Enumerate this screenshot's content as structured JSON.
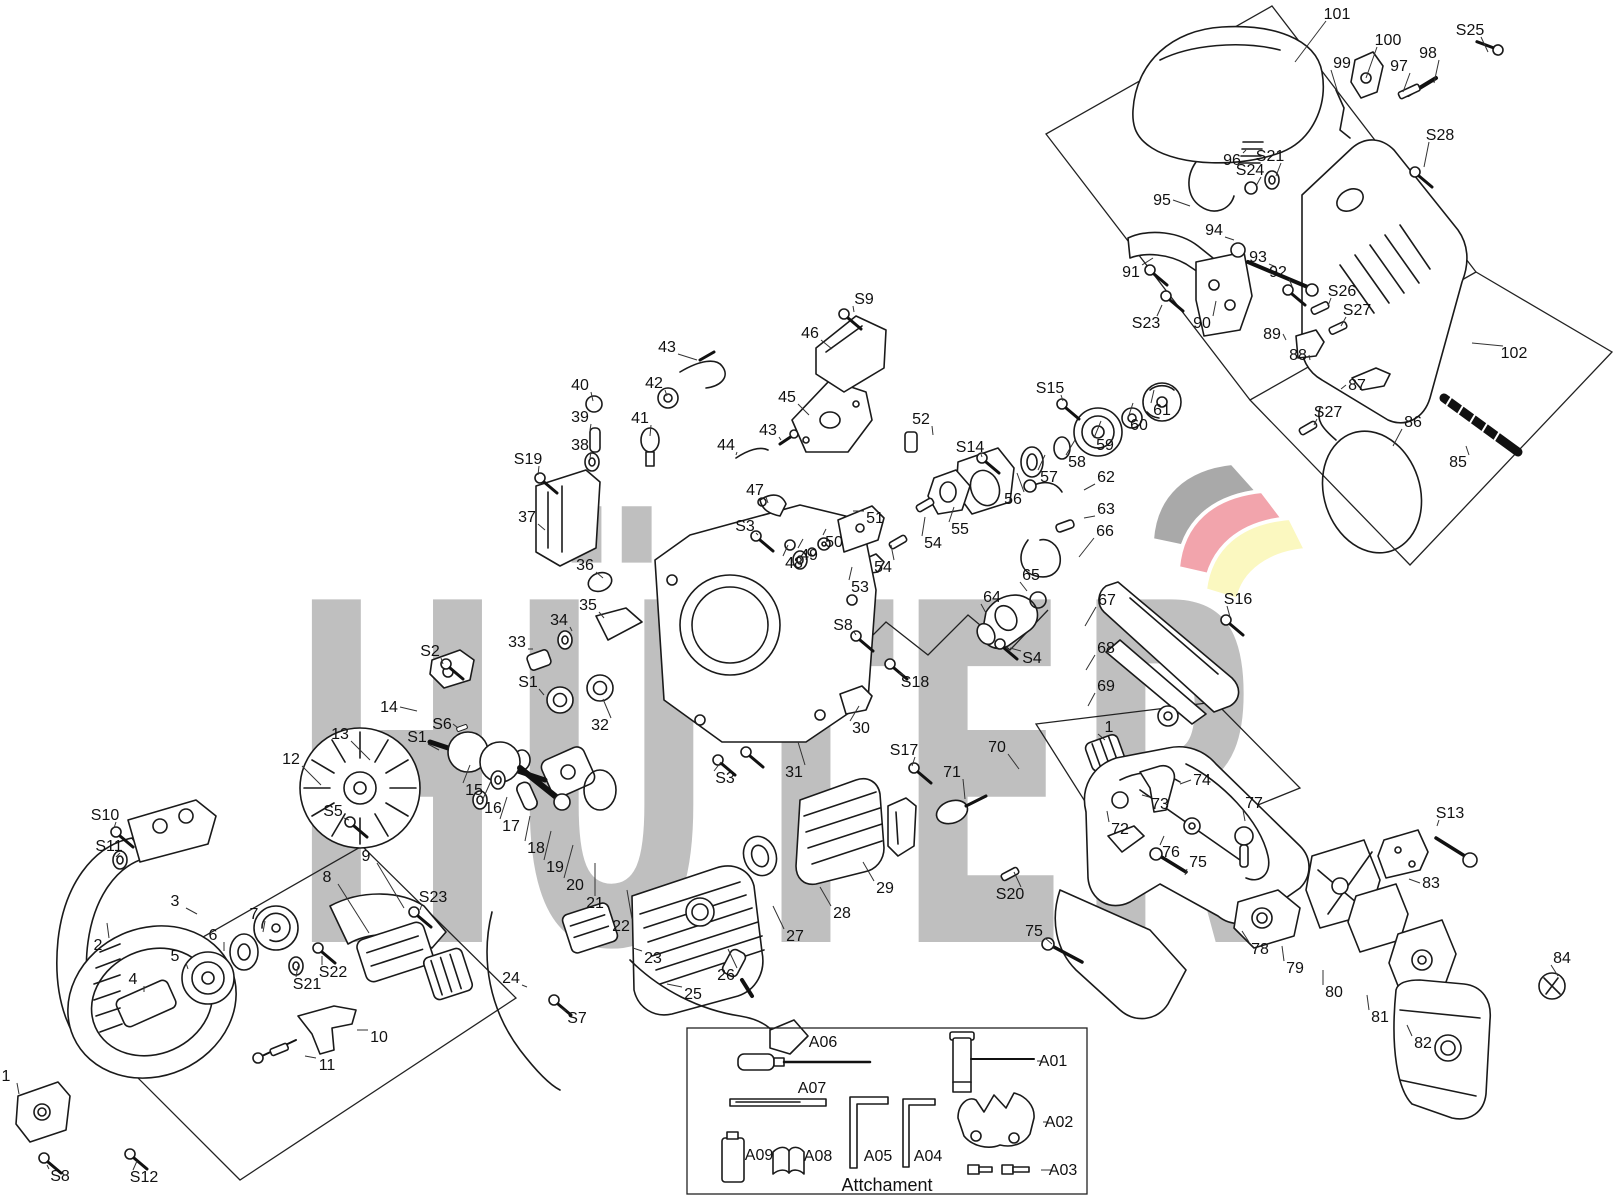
{
  "watermark": {
    "text": "HÜTER",
    "color": "#bfbfbf"
  },
  "logo": {
    "gray": "#a9a9a9",
    "red": "#f2a4ac",
    "yellow": "#fbf8c0"
  },
  "attachment_box": {
    "caption": "Attchament"
  },
  "labels": {
    "format": [
      "text",
      "x",
      "y",
      "leader_dx",
      "leader_dy"
    ],
    "items": [
      [
        "101",
        1337,
        14,
        -42,
        48
      ],
      [
        "100",
        1388,
        40,
        -22,
        38
      ],
      [
        "S25",
        1470,
        30,
        18,
        22
      ],
      [
        "99",
        1342,
        63,
        -4,
        30
      ],
      [
        "97",
        1399,
        66,
        4,
        26
      ],
      [
        "98",
        1428,
        53,
        6,
        30
      ],
      [
        "S28",
        1440,
        135,
        -16,
        32
      ],
      [
        "96",
        1232,
        160,
        14,
        -10
      ],
      [
        "S24",
        1250,
        170,
        6,
        16
      ],
      [
        "S21",
        1270,
        156,
        6,
        20
      ],
      [
        "95",
        1162,
        200,
        28,
        6
      ],
      [
        "94",
        1214,
        230,
        20,
        10
      ],
      [
        "93",
        1258,
        257,
        18,
        10
      ],
      [
        "92",
        1278,
        272,
        14,
        14
      ],
      [
        "S26",
        1342,
        291,
        -14,
        15
      ],
      [
        "S27",
        1357,
        310,
        -16,
        16
      ],
      [
        "91",
        1131,
        272,
        22,
        -14
      ],
      [
        "S23",
        1146,
        323,
        16,
        -18
      ],
      [
        "90",
        1202,
        323,
        14,
        -22
      ],
      [
        "89",
        1272,
        334,
        14,
        6
      ],
      [
        "88",
        1298,
        355,
        12,
        5
      ],
      [
        "87",
        1357,
        385,
        -16,
        4
      ],
      [
        "102",
        1514,
        353,
        -42,
        -10
      ],
      [
        "S27",
        1328,
        412,
        -14,
        13
      ],
      [
        "86",
        1413,
        422,
        -20,
        24
      ],
      [
        "85",
        1458,
        462,
        8,
        -16
      ],
      [
        "S15",
        1050,
        388,
        13,
        13
      ],
      [
        "52",
        921,
        419,
        12,
        16
      ],
      [
        "S14",
        970,
        447,
        12,
        10
      ],
      [
        "55",
        960,
        529,
        -6,
        -22
      ],
      [
        "54",
        933,
        543,
        -8,
        -26
      ],
      [
        "54",
        883,
        567,
        8,
        -22
      ],
      [
        "53",
        860,
        587,
        -8,
        -20
      ],
      [
        "56",
        1013,
        499,
        4,
        -26
      ],
      [
        "57",
        1049,
        477,
        -4,
        -22
      ],
      [
        "58",
        1077,
        462,
        -2,
        -22
      ],
      [
        "59",
        1105,
        445,
        -4,
        -24
      ],
      [
        "60",
        1139,
        425,
        -6,
        -22
      ],
      [
        "61",
        1162,
        410,
        -8,
        -20
      ],
      [
        "62",
        1106,
        477,
        -22,
        13
      ],
      [
        "63",
        1106,
        509,
        -22,
        9
      ],
      [
        "66",
        1105,
        531,
        -26,
        26
      ],
      [
        "65",
        1031,
        575,
        -4,
        16
      ],
      [
        "64",
        992,
        597,
        -6,
        16
      ],
      [
        "S4",
        1032,
        658,
        -22,
        -10
      ],
      [
        "67",
        1107,
        600,
        -22,
        26
      ],
      [
        "68",
        1106,
        648,
        -20,
        22
      ],
      [
        "69",
        1106,
        686,
        -18,
        20
      ],
      [
        "S16",
        1238,
        599,
        -8,
        18
      ],
      [
        "S18",
        915,
        682,
        -16,
        -9
      ],
      [
        "S8",
        843,
        625,
        13,
        10
      ],
      [
        "30",
        861,
        728,
        -2,
        -22
      ],
      [
        "31",
        794,
        772,
        4,
        -30
      ],
      [
        "S3",
        725,
        778,
        -4,
        -16
      ],
      [
        "S17",
        904,
        750,
        8,
        16
      ],
      [
        "29",
        885,
        888,
        -22,
        -26
      ],
      [
        "28",
        842,
        913,
        -22,
        -26
      ],
      [
        "27",
        795,
        936,
        -22,
        -30
      ],
      [
        "26",
        726,
        975,
        2,
        -26
      ],
      [
        "25",
        693,
        994,
        -26,
        -10
      ],
      [
        "23",
        653,
        958,
        -20,
        -10
      ],
      [
        "24",
        511,
        978,
        16,
        9
      ],
      [
        "S7",
        577,
        1018,
        -16,
        -10
      ],
      [
        "22",
        621,
        926,
        6,
        -36
      ],
      [
        "21",
        595,
        903,
        0,
        -40
      ],
      [
        "20",
        575,
        885,
        -2,
        -40
      ],
      [
        "19",
        555,
        867,
        -4,
        -36
      ],
      [
        "18",
        536,
        848,
        -6,
        -32
      ],
      [
        "17",
        511,
        826,
        -4,
        -29
      ],
      [
        "16",
        493,
        808,
        -2,
        -27
      ],
      [
        "15",
        474,
        790,
        -4,
        -25
      ],
      [
        "13",
        340,
        734,
        30,
        26
      ],
      [
        "12",
        291,
        759,
        30,
        26
      ],
      [
        "14",
        389,
        707,
        28,
        4
      ],
      [
        "S6",
        442,
        724,
        16,
        4
      ],
      [
        "S1",
        528,
        682,
        16,
        13
      ],
      [
        "S1",
        417,
        737,
        22,
        13
      ],
      [
        "32",
        600,
        725,
        3,
        -26
      ],
      [
        "33",
        517,
        642,
        16,
        7
      ],
      [
        "34",
        559,
        620,
        13,
        11
      ],
      [
        "35",
        588,
        605,
        16,
        13
      ],
      [
        "36",
        585,
        565,
        18,
        13
      ],
      [
        "37",
        527,
        517,
        18,
        13
      ],
      [
        "S19",
        528,
        459,
        10,
        16
      ],
      [
        "38",
        580,
        445,
        10,
        13
      ],
      [
        "39",
        580,
        417,
        10,
        13
      ],
      [
        "40",
        580,
        385,
        13,
        16
      ],
      [
        "41",
        640,
        418,
        10,
        18
      ],
      [
        "42",
        654,
        383,
        13,
        13
      ],
      [
        "43",
        667,
        347,
        30,
        13
      ],
      [
        "43",
        768,
        430,
        13,
        10
      ],
      [
        "44",
        726,
        445,
        10,
        10
      ],
      [
        "45",
        787,
        397,
        22,
        18
      ],
      [
        "46",
        810,
        333,
        22,
        16
      ],
      [
        "S9",
        864,
        299,
        -10,
        13
      ],
      [
        "47",
        755,
        490,
        13,
        13
      ],
      [
        "S3",
        745,
        526,
        13,
        9
      ],
      [
        "51",
        875,
        518,
        -22,
        -7
      ],
      [
        "50",
        834,
        542,
        -8,
        -13
      ],
      [
        "49",
        809,
        555,
        -6,
        -16
      ],
      [
        "48",
        794,
        563,
        -6,
        -18
      ],
      [
        "S2",
        430,
        651,
        13,
        13
      ],
      [
        "S5",
        333,
        811,
        16,
        9
      ],
      [
        "S10",
        105,
        815,
        9,
        13
      ],
      [
        "S11",
        109,
        846,
        7,
        11
      ],
      [
        "2",
        98,
        945,
        9,
        -22
      ],
      [
        "3",
        175,
        901,
        22,
        13
      ],
      [
        "7",
        254,
        914,
        9,
        18
      ],
      [
        "6",
        213,
        935,
        11,
        16
      ],
      [
        "5",
        175,
        956,
        13,
        13
      ],
      [
        "4",
        133,
        979,
        11,
        13
      ],
      [
        "9",
        366,
        856,
        38,
        52
      ],
      [
        "8",
        327,
        877,
        42,
        56
      ],
      [
        "S23",
        433,
        897,
        -13,
        13
      ],
      [
        "S22",
        333,
        972,
        -11,
        -16
      ],
      [
        "S21",
        307,
        984,
        -9,
        -18
      ],
      [
        "10",
        379,
        1037,
        -22,
        -7
      ],
      [
        "11",
        327,
        1065,
        -22,
        -9
      ],
      [
        "1",
        6,
        1076,
        13,
        18
      ],
      [
        "S8",
        60,
        1176,
        -13,
        -11
      ],
      [
        "S12",
        144,
        1177,
        -7,
        -16
      ],
      [
        "70",
        997,
        747,
        22,
        22
      ],
      [
        "1",
        1109,
        727,
        -4,
        13
      ],
      [
        "71",
        952,
        772,
        13,
        27
      ],
      [
        "74",
        1202,
        780,
        -22,
        4
      ],
      [
        "73",
        1160,
        804,
        -18,
        -9
      ],
      [
        "72",
        1120,
        829,
        -13,
        -18
      ],
      [
        "77",
        1254,
        803,
        -9,
        18
      ],
      [
        "76",
        1171,
        852,
        -7,
        -16
      ],
      [
        "75",
        1198,
        862,
        -13,
        13
      ],
      [
        "S20",
        1010,
        894,
        4,
        -22
      ],
      [
        "75",
        1034,
        931,
        18,
        13
      ],
      [
        "78",
        1260,
        949,
        -18,
        -18
      ],
      [
        "79",
        1295,
        968,
        -13,
        -22
      ],
      [
        "80",
        1334,
        992,
        -11,
        -22
      ],
      [
        "81",
        1380,
        1017,
        -13,
        -22
      ],
      [
        "82",
        1423,
        1043,
        -16,
        -18
      ],
      [
        "83",
        1431,
        883,
        -22,
        -4
      ],
      [
        "S13",
        1450,
        813,
        -13,
        13
      ],
      [
        "84",
        1562,
        958,
        -4,
        18
      ],
      [
        "A06",
        823,
        1042,
        0,
        0
      ],
      [
        "A01",
        1053,
        1061,
        -16,
        0
      ],
      [
        "A07",
        812,
        1088,
        0,
        0
      ],
      [
        "A02",
        1059,
        1122,
        -16,
        0
      ],
      [
        "A09",
        759,
        1155,
        -12,
        0
      ],
      [
        "A08",
        818,
        1156,
        -12,
        0
      ],
      [
        "A05",
        878,
        1156,
        -12,
        0
      ],
      [
        "A04",
        928,
        1156,
        -12,
        0
      ],
      [
        "A03",
        1063,
        1170,
        -22,
        0
      ]
    ]
  }
}
